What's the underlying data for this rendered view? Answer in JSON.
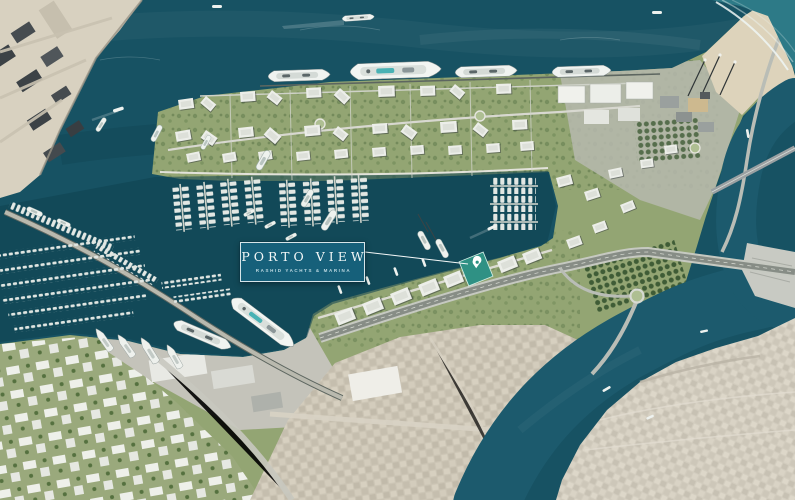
{
  "scene": {
    "type": "aerial-masterplan-render",
    "project": {
      "title": "PORTO VIEW",
      "subtitle": "RASHID YACHTS & MARINA"
    },
    "colors": {
      "sea": "#175263",
      "marina_water": "#0f4251",
      "creek": "#1c5a6d",
      "surf_lagoon": "#2d7a87",
      "label_bg": "#16607a",
      "label_border": "#ebf4f5",
      "highlight_building": "#2f9184",
      "land_green": "#93a573",
      "sand": "#d8d1c0",
      "urban": "#cbc4b4"
    }
  }
}
